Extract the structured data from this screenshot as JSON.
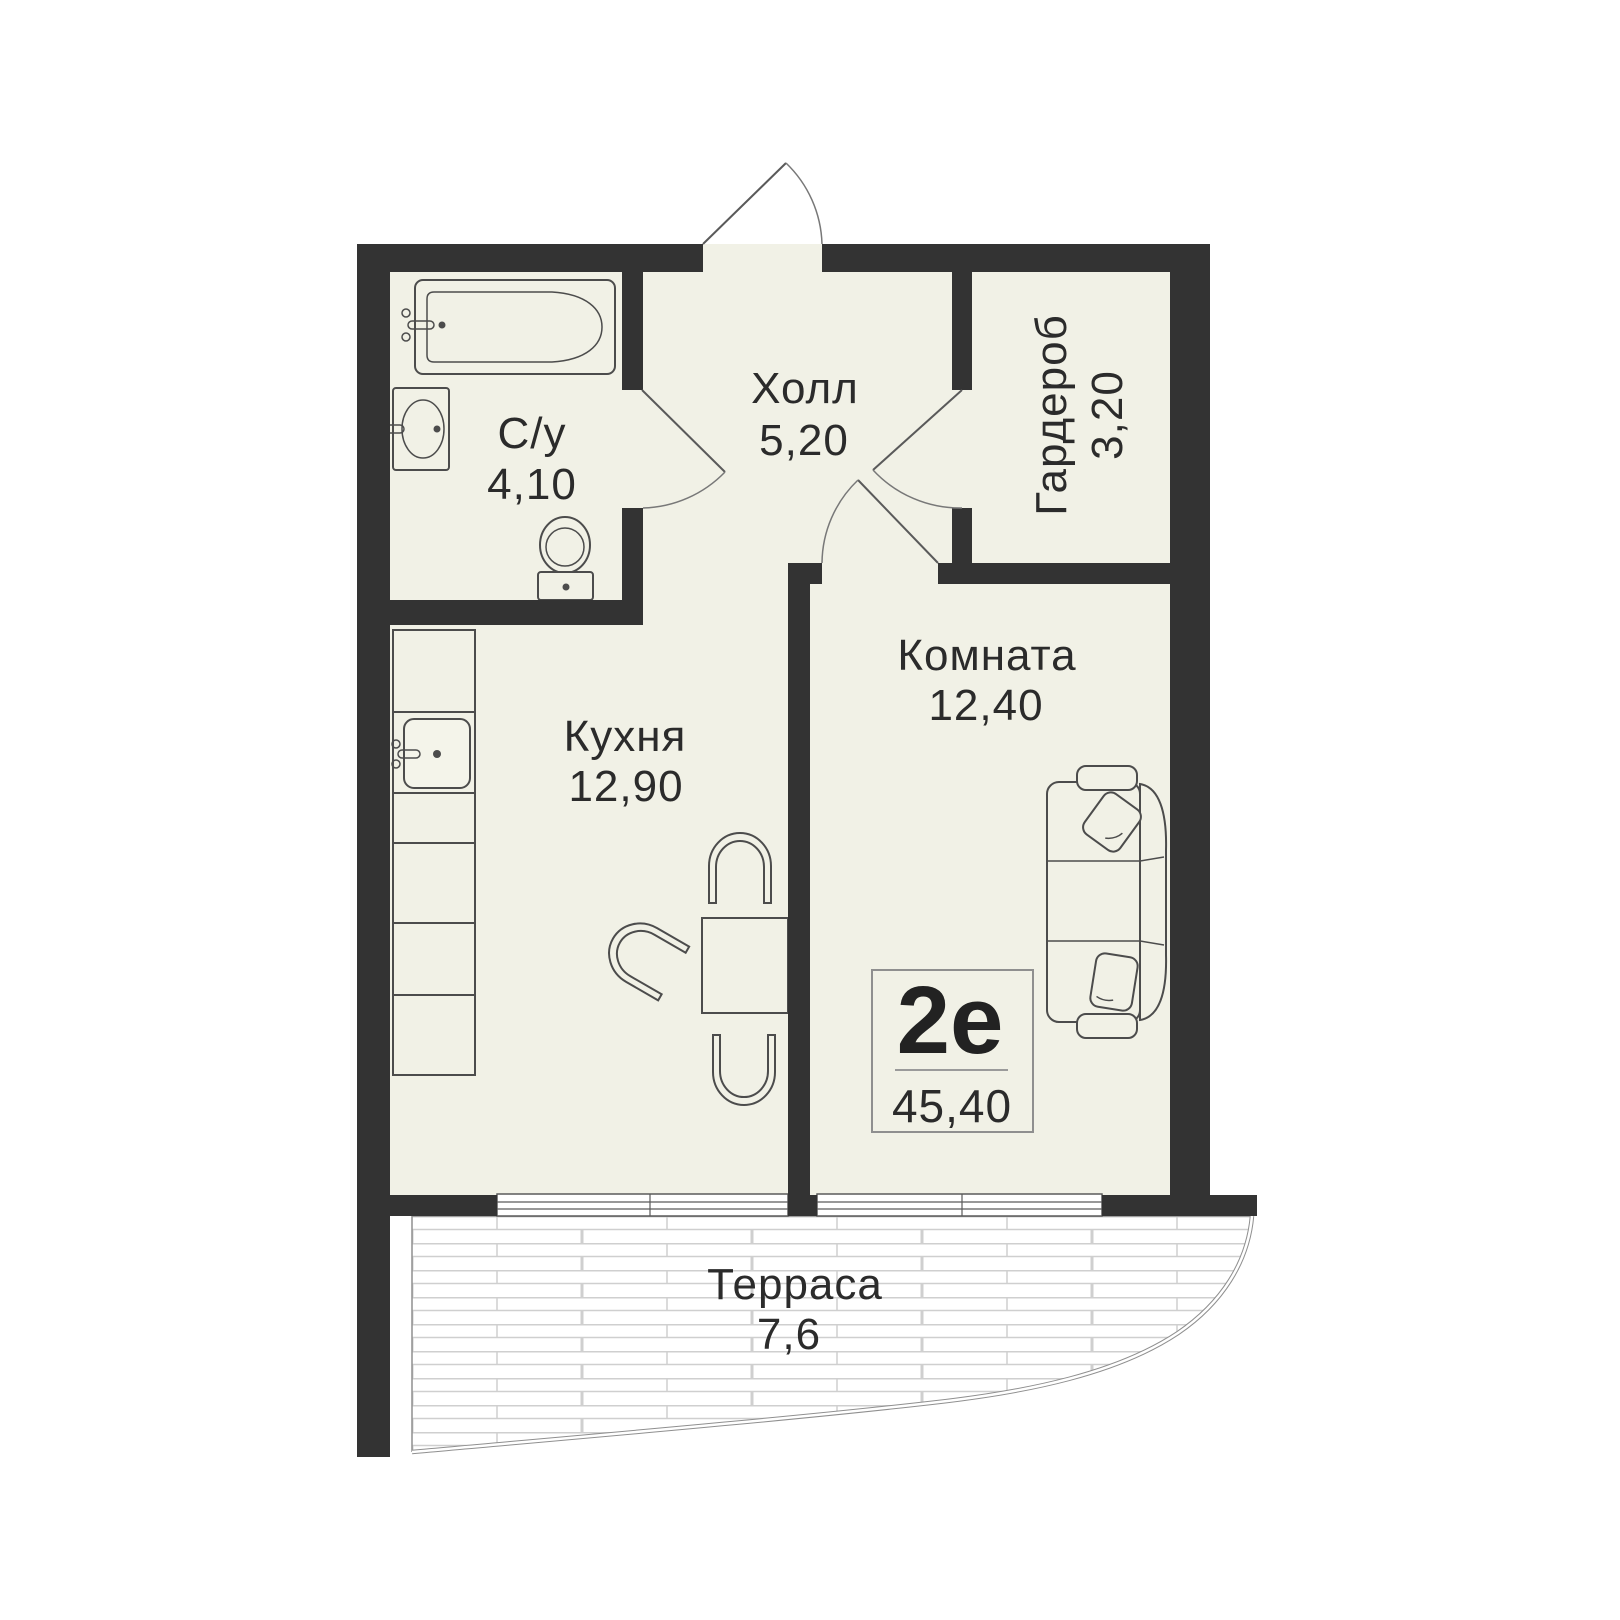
{
  "badge": {
    "type": "2е",
    "total_area": "45,40"
  },
  "rooms": {
    "hall": {
      "name": "Холл",
      "area": "5,20"
    },
    "bathroom": {
      "name": "С/у",
      "area": "4,10"
    },
    "wardrobe": {
      "name": "Гардероб",
      "area": "3,20"
    },
    "room": {
      "name": "Комната",
      "area": "12,40"
    },
    "kitchen": {
      "name": "Кухня",
      "area": "12,90"
    },
    "terrace": {
      "name": "Терраса",
      "area": "7,6"
    }
  },
  "colors": {
    "wall": "#333333",
    "floor": "#f1f1e6",
    "outline": "#4c4c4c",
    "text": "#2b2b2b",
    "terrace_hatch": "#cfcfcf",
    "terrace_border": "#8f8f8f",
    "background": "#ffffff"
  }
}
